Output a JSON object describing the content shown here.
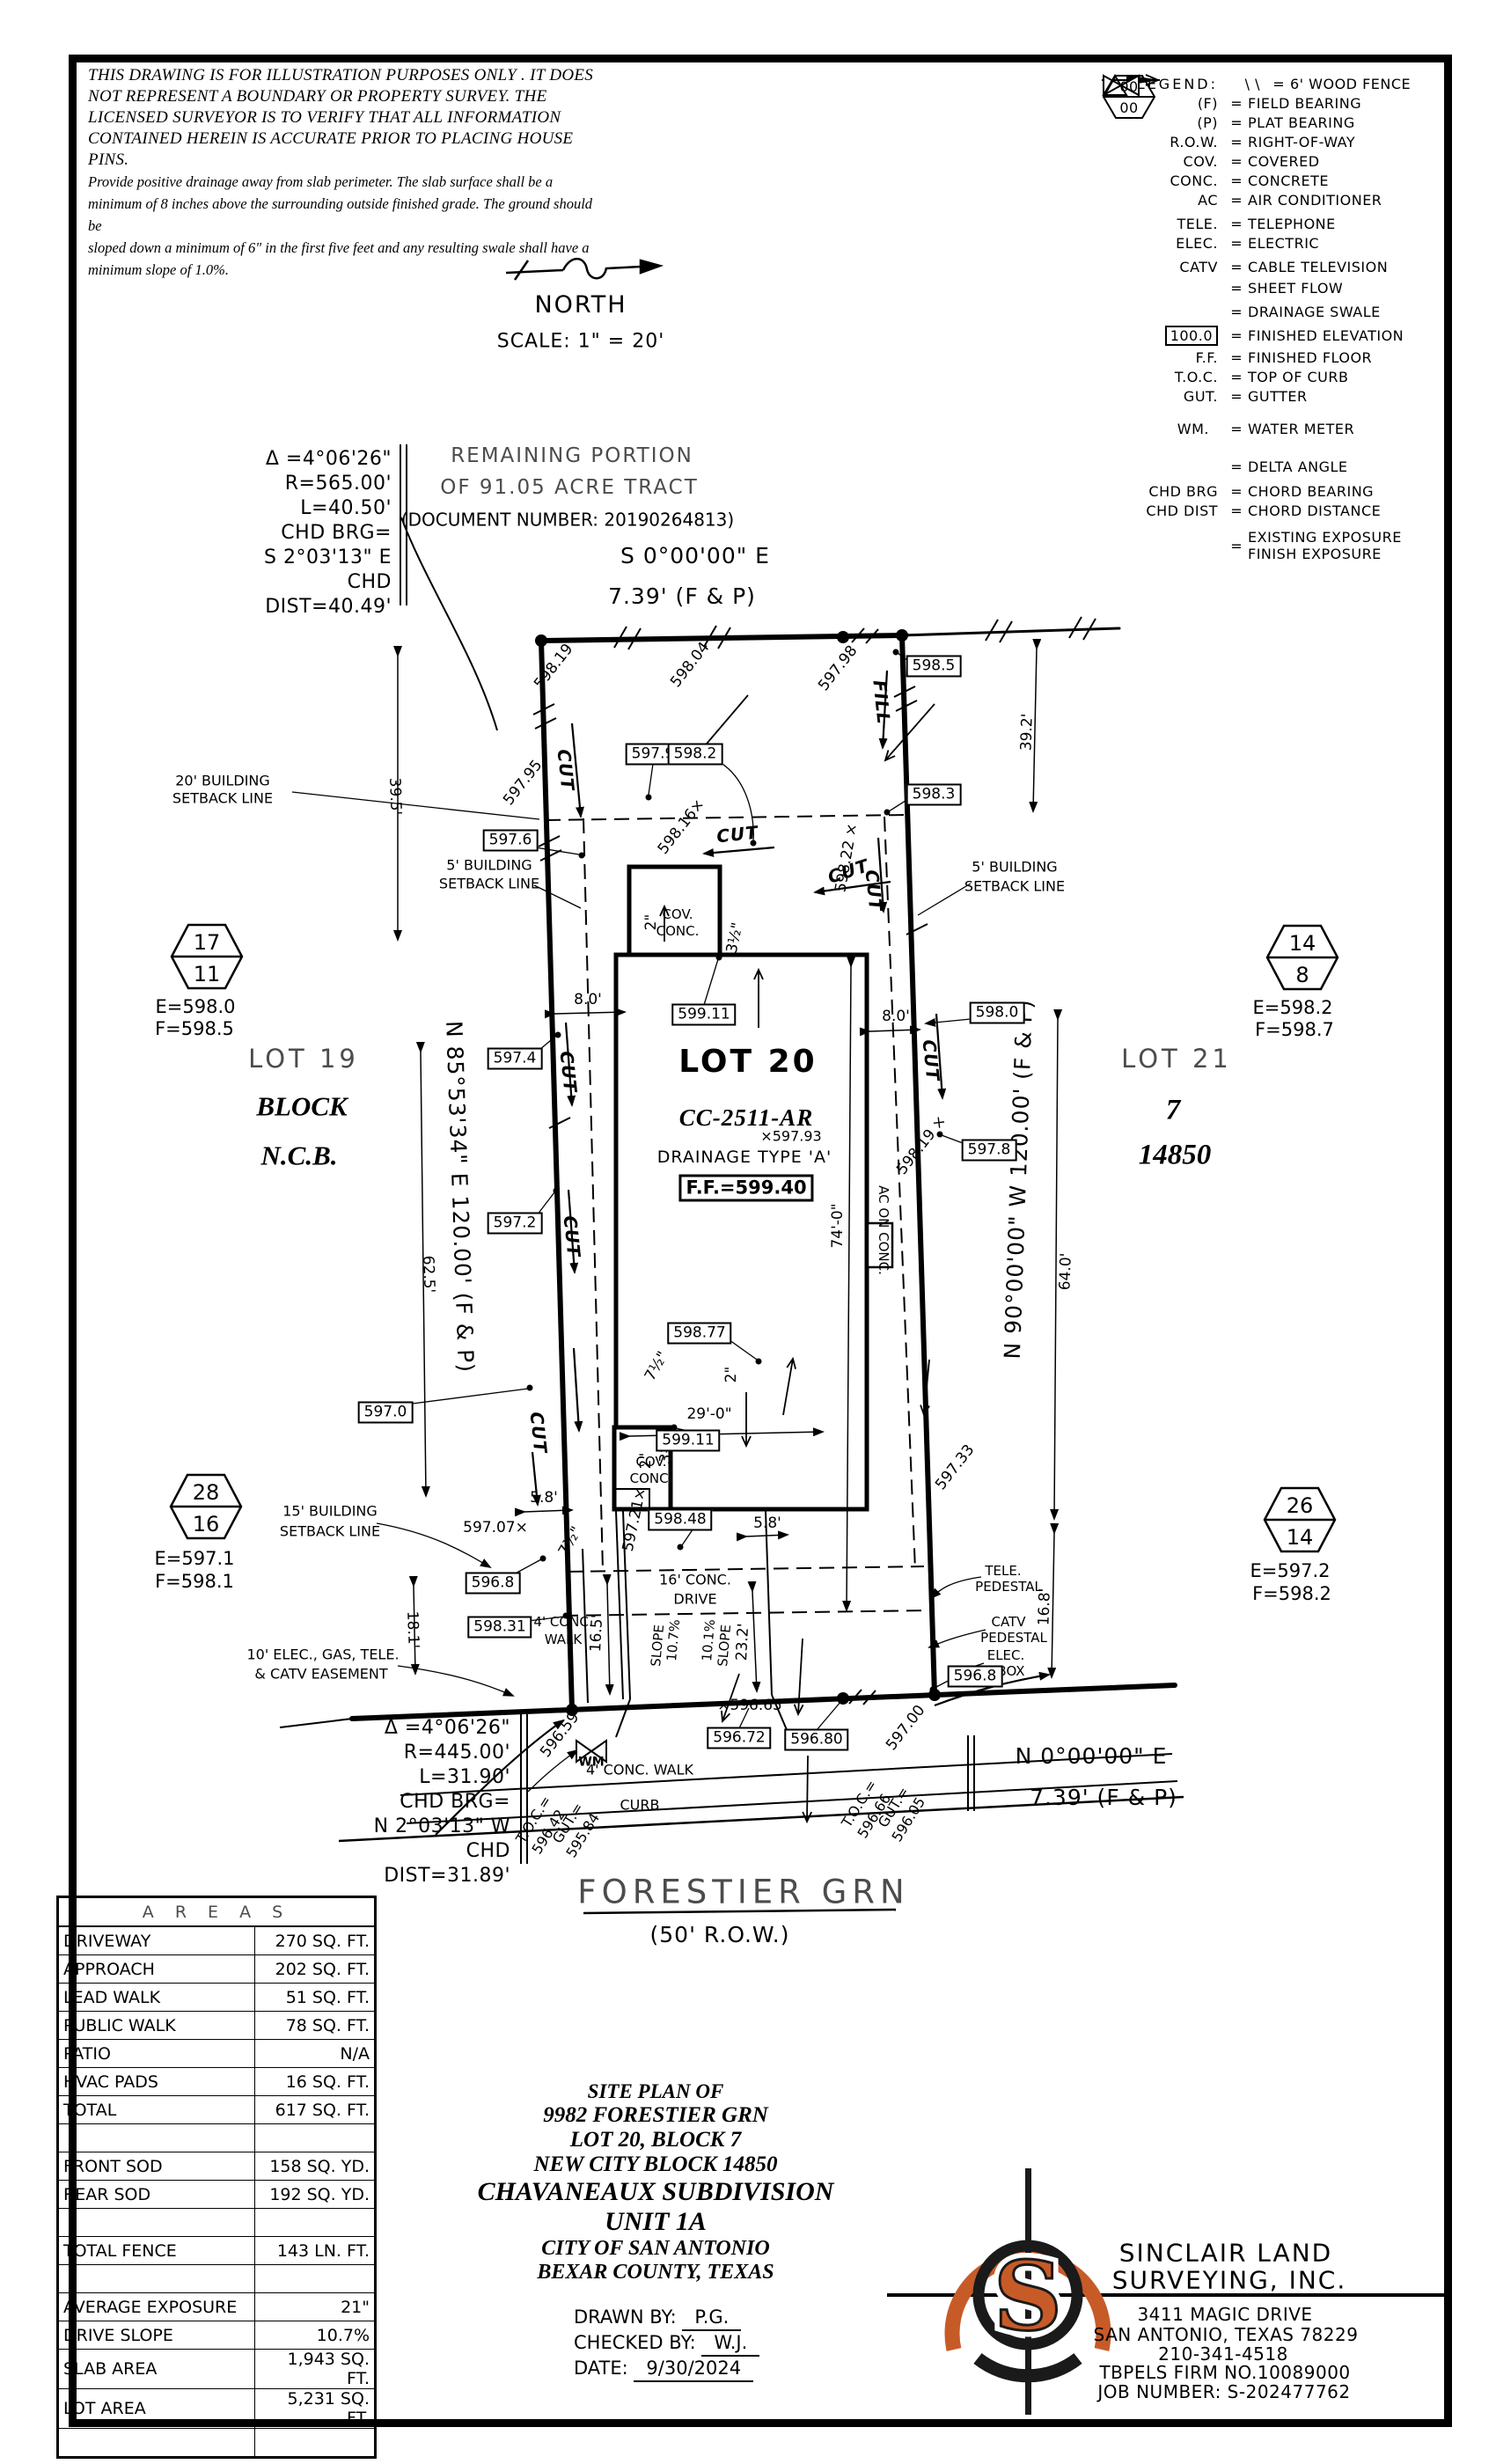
{
  "page": {
    "disclaimer": [
      "THIS DRAWING IS FOR ILLUSTRATION PURPOSES ONLY . IT DOES",
      "NOT REPRESENT A BOUNDARY OR PROPERTY SURVEY. THE",
      "LICENSED SURVEYOR IS TO VERIFY THAT ALL INFORMATION",
      "CONTAINED HEREIN IS ACCURATE PRIOR TO PLACING HOUSE PINS.",
      "Provide positive drainage away from slab perimeter. The slab surface shall be a",
      "minimum of 8 inches above the surrounding outside finished grade. The ground should be",
      "sloped down a minimum of 6\" in the first five feet and any resulting swale shall have a",
      "minimum slope of 1.0%."
    ],
    "north_label": "NORTH",
    "scale_label": "SCALE:  1\" = 20'"
  },
  "legend": {
    "title": "LEGEND:",
    "eq": "=",
    "rows": [
      {
        "sym": "\\ \\",
        "desc": "6' WOOD FENCE"
      },
      {
        "sym": "(F)",
        "desc": "FIELD BEARING"
      },
      {
        "sym": "(P)",
        "desc": "PLAT BEARING"
      },
      {
        "sym": "R.O.W.",
        "desc": "RIGHT-OF-WAY"
      },
      {
        "sym": "COV.",
        "desc": "COVERED"
      },
      {
        "sym": "CONC.",
        "desc": "CONCRETE"
      },
      {
        "sym": "AC",
        "desc": "AIR CONDITIONER"
      },
      {
        "sym": "TELE.",
        "desc": "TELEPHONE"
      },
      {
        "sym": "ELEC.",
        "desc": "ELECTRIC"
      },
      {
        "sym": "CATV",
        "desc": "CABLE TELEVISION"
      },
      {
        "sym": "",
        "desc": "SHEET FLOW"
      },
      {
        "sym": "",
        "desc": "DRAINAGE SWALE"
      },
      {
        "sym": "100.0",
        "desc": "FINISHED ELEVATION"
      },
      {
        "sym": "F.F.",
        "desc": "FINISHED FLOOR"
      },
      {
        "sym": "T.O.C.",
        "desc": "TOP OF CURB"
      },
      {
        "sym": "GUT.",
        "desc": "GUTTER"
      },
      {
        "sym": "WM.",
        "desc": "WATER METER"
      },
      {
        "sym": "",
        "desc": "DELTA ANGLE"
      },
      {
        "sym": "CHD BRG",
        "desc": "CHORD BEARING"
      },
      {
        "sym": "CHD DIST",
        "desc": "CHORD DISTANCE"
      },
      {
        "sym": "00",
        "sym2": "00",
        "desc": "EXISTING EXPOSURE",
        "desc2": "FINISH EXPOSURE"
      }
    ]
  },
  "curves": {
    "top": [
      "Δ =4°06'26\"",
      "R=565.00'",
      "L=40.50'",
      "CHD BRG=",
      "S 2°03'13\" E",
      "CHD DIST=40.49'"
    ],
    "bottom": [
      "Δ =4°06'26\"",
      "R=445.00'",
      "L=31.90'",
      "CHD BRG=",
      "N 2°03'13\" W",
      "CHD DIST=31.89'"
    ]
  },
  "tract": {
    "l1": "REMAINING PORTION",
    "l2": "OF 91.05 ACRE TRACT",
    "l3": "(DOCUMENT NUMBER: 20190264813)"
  },
  "bearings": {
    "top1": "S 0°00'00\" E",
    "top2": "7.39' (F & P)",
    "bottom1": "N 0°00'00\" E",
    "bottom2": "7.39' (F & P)",
    "left": "N 85°53'34\" E 120.00' (F & P)",
    "right": "N 90°00'00\" W 120.00' (F & P)"
  },
  "lots": {
    "lot19": {
      "name": "LOT 19",
      "block": "BLOCK",
      "ncb": "N.C.B."
    },
    "lot21": {
      "name": "LOT 21",
      "block": "7",
      "ncb": "14850"
    },
    "lot20": {
      "name": "LOT 20",
      "cc": "CC-2511-AR",
      "spot": "×597.93",
      "drainage": "DRAINAGE TYPE 'A'",
      "ff": "F.F.=599.40"
    }
  },
  "markers": {
    "m17": {
      "top": "17",
      "bot": "11",
      "e": "E=598.0",
      "f": "F=598.5"
    },
    "m14": {
      "top": "14",
      "bot": "8",
      "e": "E=598.2",
      "f": "F=598.7"
    },
    "m28": {
      "top": "28",
      "bot": "16",
      "e": "E=597.1",
      "f": "F=598.1"
    },
    "m26": {
      "top": "26",
      "bot": "14",
      "e": "E=597.2",
      "f": "F=598.2"
    }
  },
  "plan": {
    "setbacks": {
      "s20a": "20' BUILDING",
      "s5": "5' BUILDING",
      "s15a": "15' BUILDING",
      "sl": "SETBACK LINE",
      "e1": "10' ELEC., GAS, TELE.",
      "e2": "& CATV EASEMENT"
    },
    "features": {
      "cov": "COV.",
      "conc": "CONC.",
      "ac": "AC ON CONC.",
      "drive1": "16' CONC.",
      "drive2": "DRIVE",
      "walk1": "4' CONC.",
      "walk2": "WALK",
      "walk_full": "4' CONC. WALK",
      "curb": "CURB",
      "wm": "WM",
      "tele": "TELE.",
      "ped": "PEDESTAL",
      "catv": "CATV",
      "elec": "ELEC.",
      "box": "BOX",
      "slope_word": "SLOPE",
      "slope1": "10.7%",
      "slope2": "10.1%"
    },
    "flow": {
      "cut": "CUT",
      "fill": "FILL"
    },
    "dims": {
      "d39_5": "39.5'",
      "d62_5": "62.5'",
      "d18_1": "18.1'",
      "d39_2": "39.2'",
      "d64_0": "64.0'",
      "d16_8": "16.8'",
      "d74_0": "74'-0\"",
      "d29_0": "29'-0\"",
      "d16_5": "16.5'",
      "d23_2": "23.2'",
      "d8_0": "8.0'",
      "d5_8": "5.8'",
      "d2": "2\"",
      "d3_5": "3½\"",
      "d7_5": "7½\""
    },
    "boxed": {
      "b598_5": "598.5",
      "b598_3": "598.3",
      "b597_9": "597.9",
      "b598_2": "598.2",
      "b597_6": "597.6",
      "b599_11": "599.11",
      "b598_0": "598.0",
      "b597_4": "597.4",
      "b597_8": "597.8",
      "b597_2": "597.2",
      "b598_77": "598.77",
      "b597_0": "597.0",
      "b598_48": "598.48",
      "b596_8": "596.8",
      "b598_31": "598.31",
      "b596_72": "596.72",
      "b596_80": "596.80"
    },
    "spots": {
      "s598_19": "598.19",
      "s598_04": "598.04",
      "s597_98": "597.98",
      "s597_95": "597.95",
      "s598_16": "598.16×",
      "s598_22": "598.22 ×",
      "s598_19x": "598.19 ×",
      "s597_21": "597.21×",
      "s597_07": "597.07×",
      "s597_33": "597.33",
      "s596_59": "596.59",
      "s596_65": "×596.65",
      "s597_00": "597.00"
    },
    "toc": {
      "toc": "T.O.C.=",
      "gut": "GUT.=",
      "l_toc": "596.42",
      "l_gut": "595.84",
      "r_toc": "596.66",
      "r_gut": "596.05"
    }
  },
  "street": {
    "name": "FORESTIER GRN",
    "row": "(50' R.O.W.)"
  },
  "areas_table": {
    "title": "A R E A S",
    "rows": [
      {
        "label": "DRIVEWAY",
        "value": "270 SQ. FT."
      },
      {
        "label": "APPROACH",
        "value": "202 SQ. FT."
      },
      {
        "label": "LEAD WALK",
        "value": "51 SQ. FT."
      },
      {
        "label": "PUBLIC WALK",
        "value": "78 SQ. FT."
      },
      {
        "label": "PATIO",
        "value": "N/A"
      },
      {
        "label": "HVAC PADS",
        "value": "16 SQ. FT."
      },
      {
        "label": "TOTAL",
        "value": "617 SQ. FT."
      },
      {
        "label": "",
        "value": ""
      },
      {
        "label": "FRONT SOD",
        "value": "158 SQ. YD."
      },
      {
        "label": "REAR SOD",
        "value": "192 SQ. YD."
      },
      {
        "label": "",
        "value": ""
      },
      {
        "label": "TOTAL FENCE",
        "value": "143 LN. FT."
      },
      {
        "label": "",
        "value": ""
      },
      {
        "label": "AVERAGE EXPOSURE",
        "value": "21\""
      },
      {
        "label": "DRIVE SLOPE",
        "value": "10.7%"
      },
      {
        "label": "SLAB AREA",
        "value": "1,943 SQ. FT."
      },
      {
        "label": "LOT AREA",
        "value": "5,231 SQ. FT."
      },
      {
        "label": "",
        "value": ""
      }
    ]
  },
  "title_block": {
    "l1": "SITE PLAN OF",
    "l2": "9982 FORESTIER GRN",
    "l3": "LOT 20, BLOCK 7",
    "l4": "NEW CITY BLOCK 14850",
    "l5": "CHAVANEAUX SUBDIVISION",
    "l6": "UNIT 1A",
    "l7": "CITY OF SAN ANTONIO",
    "l8": "BEXAR COUNTY, TEXAS",
    "drawn_label": "DRAWN BY:",
    "drawn": "P.G.",
    "checked_label": "CHECKED BY:",
    "checked": "W.J.",
    "date_label": "DATE:",
    "date": "9/30/2024"
  },
  "firm": {
    "name1": "SINCLAIR LAND",
    "name2": "SURVEYING, INC.",
    "addr1": "3411 MAGIC DRIVE",
    "addr2": "SAN ANTONIO, TEXAS 78229",
    "phone": "210-341-4518",
    "firm_no": "TBPELS FIRM NO.10089000",
    "job": "JOB NUMBER: S-202477762",
    "logo_letter": "S"
  },
  "colors": {
    "ink": "#000000",
    "logo_orange": "#c75b28",
    "paper": "#ffffff"
  }
}
